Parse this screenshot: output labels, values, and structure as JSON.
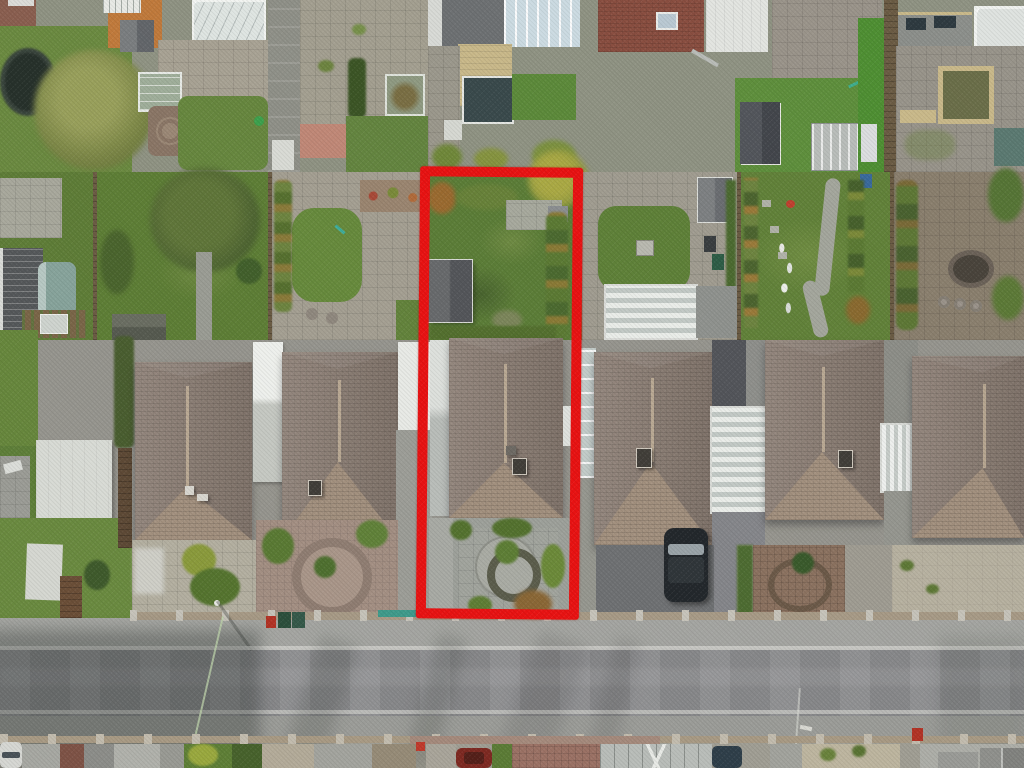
{
  "scene": {
    "description": "Aerial drone photograph of a suburban street of detached hip-roofed bungalows with long rear gardens; a red rectangle outlines the full plot of the centre property including rear garden, bungalow and front garden with circular paved feature; a grey road with pavements crosses the bottom of the frame.",
    "view": "top-down aerial",
    "annotation": {
      "name": "property-boundary-highlight",
      "shape": "rectangle",
      "color": "#e81313",
      "label": "Highlighted plot for sale"
    }
  },
  "palette": {
    "boundary": "#e81313",
    "road": "#8c8d8f",
    "pavement_n": "#a4a5a1",
    "pavement_s": "#9b9c98",
    "kerb": "#cbcbc7",
    "roof": "#8d7f75",
    "roof_gable": "#a3917f",
    "lawn": "#5f7d38",
    "lawn_bright": "#6f9542",
    "patio": "#a6a79b",
    "stone": "#b3ab98",
    "fence": "#6b5c44",
    "hedge": "#4c642f",
    "shed_dark": "#5b5d5f",
    "white_roof": "#e6e8e4",
    "conservatory_glass": "#ccdbe2",
    "block_paving": "#8b7260",
    "brick_drive": "#a38f83",
    "gravel": "#b7b1a0",
    "car_dark": "#23282c",
    "car_white": "#d6d7d3",
    "car_red": "#7e2a22",
    "car_blue": "#2f3f4a",
    "bin_green": "#2c4f3c",
    "bin_red": "#b23326",
    "wire": "#bcd2aa"
  },
  "houses": [
    {
      "label": "neighbouring bungalow 1 (far left), hipped tiled roof"
    },
    {
      "label": "neighbouring bungalow 2 (left of highlighted plot), hipped tiled roof"
    },
    {
      "label": "highlighted bungalow inside red boundary, hipped tiled roof with chimney"
    },
    {
      "label": "neighbouring bungalow 3 (right of highlighted plot), hipped tiled roof"
    },
    {
      "label": "neighbouring bungalow 4, hipped tiled roof"
    },
    {
      "label": "neighbouring bungalow 5 (far right, partly cropped), hipped tiled roof"
    }
  ],
  "vehicles": [
    {
      "label": "dark car parked on driveway right of highlighted plot",
      "color": "#23282c"
    },
    {
      "label": "white car at bottom-left kerb",
      "color": "#d6d7d3"
    },
    {
      "label": "dark red car in south front garden",
      "color": "#7e2a22"
    },
    {
      "label": "blue-grey car on south driveway",
      "color": "#2f3f4a"
    },
    {
      "label": "yellow trailer in top-left rear garden",
      "color": "#d8b13a"
    },
    {
      "label": "dark blue car at top-left edge",
      "color": "#2e4a6e"
    }
  ],
  "garden_features": [
    {
      "label": "circular paved feature with planted ring in highlighted front garden"
    },
    {
      "label": "circular brick feature in neighbour front garden"
    },
    {
      "label": "garden sheds in rear gardens"
    },
    {
      "label": "white conservatories and glazed roofs"
    },
    {
      "label": "trampoline top-left garden"
    },
    {
      "label": "wheelie bins on pavement"
    },
    {
      "label": "large olive-green tree left side"
    }
  ]
}
